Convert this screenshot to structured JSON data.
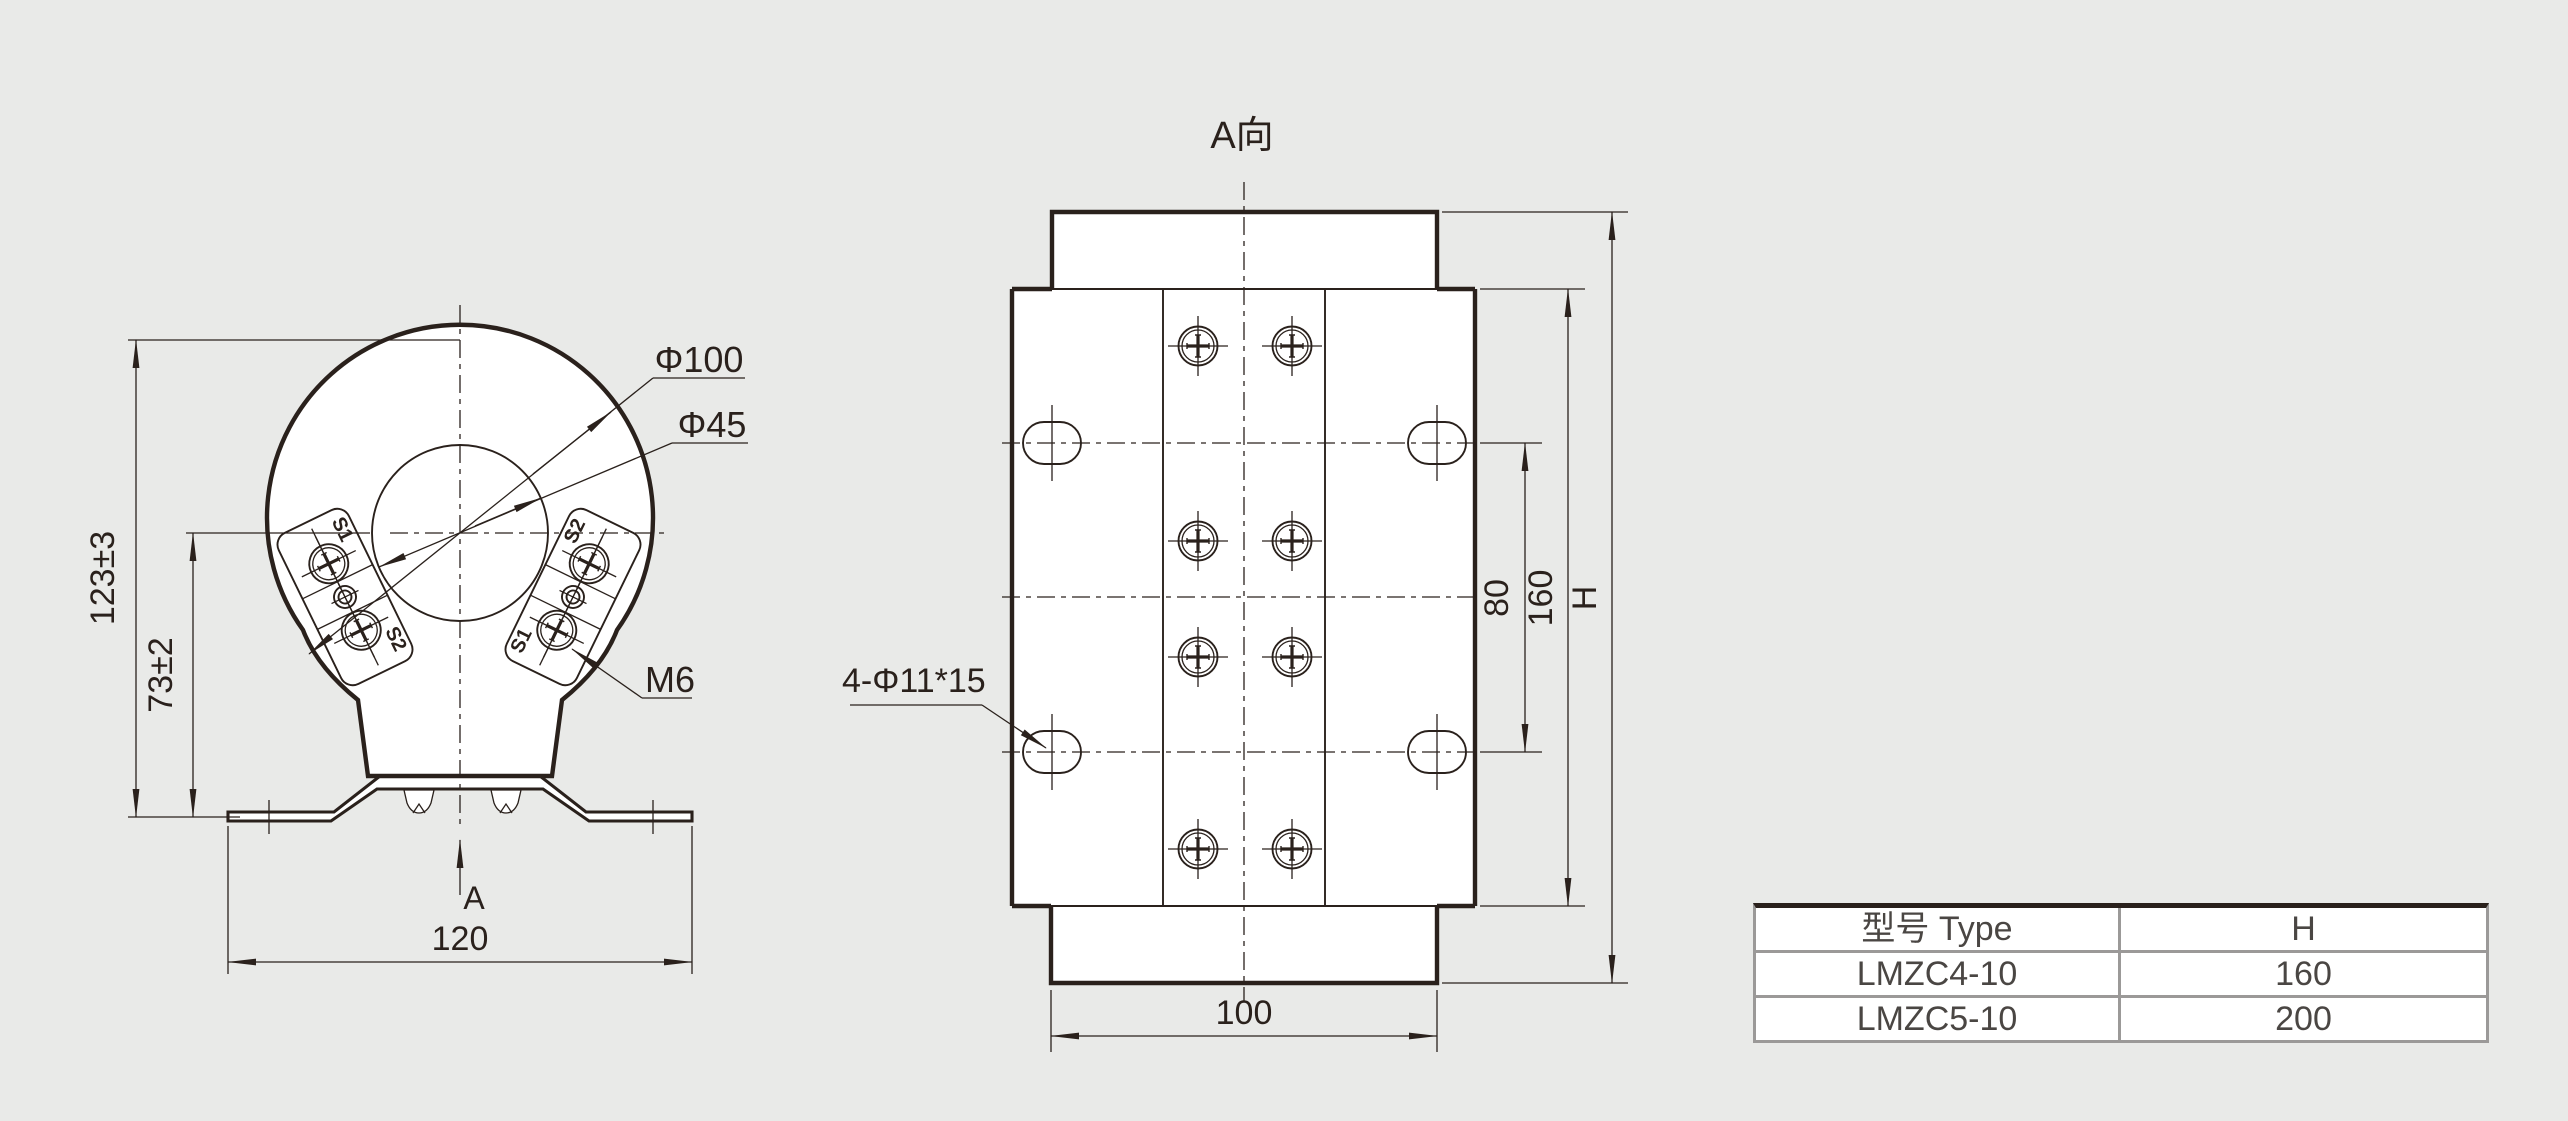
{
  "colors": {
    "background": "#e9eae8",
    "line_ink": "#2a211c",
    "table_line": "#9b9998",
    "table_text": "#4a4643",
    "fill": "#ffffff"
  },
  "left_view": {
    "labels": {
      "outer_diameter": "Φ100",
      "bore_diameter": "Φ45",
      "terminal_thread": "M6",
      "terminal_s1": "S1",
      "terminal_s2": "S2"
    },
    "dims": {
      "overall_height": "123±3",
      "center_height": "73±2",
      "bracket_width": "120"
    },
    "view_arrow": "A"
  },
  "right_view": {
    "title": "A向",
    "slot_note": "4-Φ11*15",
    "dims": {
      "slot_spacing": "80",
      "body_height": "160",
      "overall_height": "H",
      "base_width": "100"
    }
  },
  "table": {
    "headers": [
      "型号 Type",
      "H"
    ],
    "rows": [
      [
        "LMZC4-10",
        "160"
      ],
      [
        "LMZC5-10",
        "200"
      ]
    ]
  }
}
